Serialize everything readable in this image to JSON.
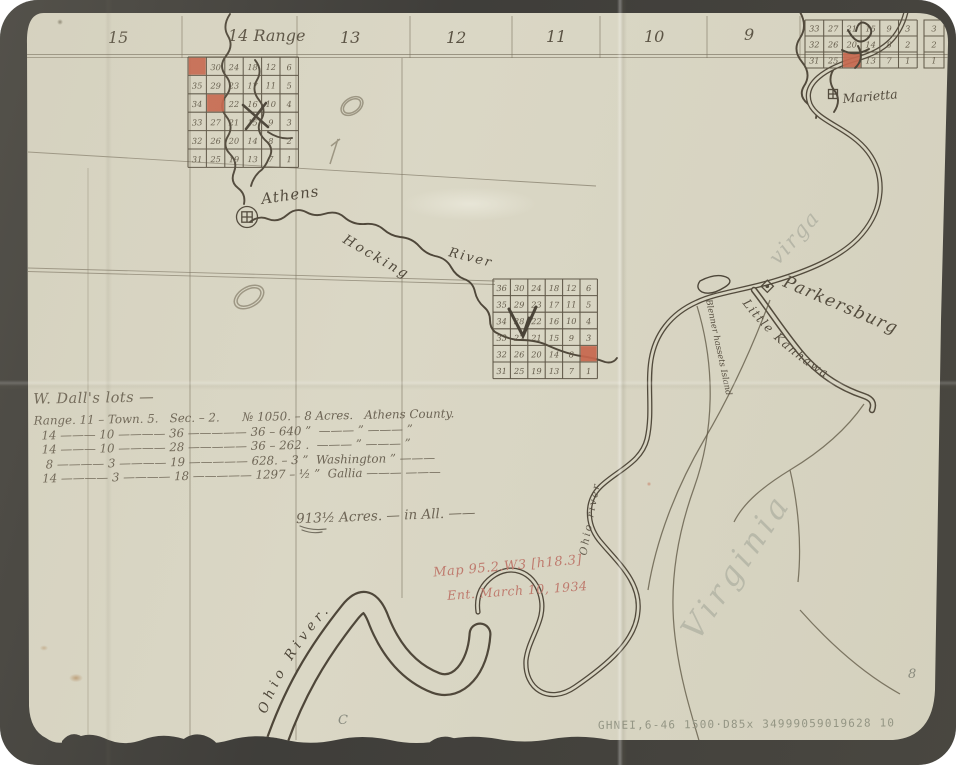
{
  "photo": {
    "background": "#111010",
    "paper_color": "#d8d5c3"
  },
  "colors": {
    "ink": "#241b0f",
    "faded_ink": "#43392a",
    "survey_line": "#5a523f",
    "section_red": "#c14227",
    "red_pencil": "#b65d52",
    "pencil": "#6f7268",
    "catalog_pencil": "#7d8171",
    "ghost": "#8f948a"
  },
  "map": {
    "range_labels": [
      {
        "text": "15"
      },
      {
        "text": "14 Range"
      },
      {
        "text": "13"
      },
      {
        "text": "12"
      },
      {
        "text": "11"
      },
      {
        "text": "10"
      },
      {
        "text": "9"
      }
    ],
    "places": {
      "athens": "Athens",
      "marietta": "Marietta",
      "parkersburg": "Parkersburg",
      "blennerhassett": "Blenner hassets Island"
    },
    "rivers": {
      "hocking_word1": "Hocking",
      "hocking_word2": "River",
      "ohio_channel": "Ohio River.",
      "ohio_small": "Ohio river",
      "little_kanhawa": "Little Kanhawa"
    },
    "ghost_text": {
      "top_right": "virga",
      "bottom_right": "Virginia"
    },
    "state_letters": "O I O"
  },
  "grids": [
    {
      "id": "township-grid-athens",
      "x": 188,
      "y": 57,
      "cell_w": 18.4,
      "cell_h": 18.4,
      "rows": 6,
      "columns": [
        [
          36,
          35,
          34,
          33,
          32,
          31
        ],
        [
          30,
          29,
          28,
          27,
          26,
          25
        ],
        [
          24,
          23,
          22,
          21,
          20,
          19
        ],
        [
          18,
          17,
          16,
          15,
          14,
          13
        ],
        [
          12,
          11,
          10,
          9,
          8,
          7
        ],
        [
          6,
          5,
          4,
          3,
          2,
          1
        ]
      ],
      "red_cells": [
        {
          "row": 0,
          "col": 0
        },
        {
          "row": 2,
          "col": 1
        }
      ]
    },
    {
      "id": "township-grid-hocking",
      "x": 493,
      "y": 279,
      "cell_w": 17.4,
      "cell_h": 16.6,
      "rows": 6,
      "columns": [
        [
          36,
          35,
          34,
          33,
          32,
          31
        ],
        [
          30,
          29,
          28,
          27,
          26,
          25
        ],
        [
          24,
          23,
          22,
          21,
          20,
          19
        ],
        [
          18,
          17,
          16,
          15,
          14,
          13
        ],
        [
          12,
          11,
          10,
          9,
          8,
          7
        ],
        [
          6,
          5,
          4,
          3,
          2,
          1
        ]
      ],
      "red_cells": [
        {
          "row": 4,
          "col": 5
        }
      ]
    },
    {
      "id": "township-grid-marietta",
      "x": 805,
      "y": 20,
      "cell_w": 18.7,
      "cell_h": 16,
      "rows": 3,
      "columns": [
        [
          33,
          32,
          31
        ],
        [
          27,
          26,
          25
        ],
        [
          21,
          20,
          19
        ],
        [
          15,
          14,
          13
        ],
        [
          9,
          8,
          7
        ],
        [
          3,
          2,
          1
        ]
      ],
      "red_cells": [
        {
          "row": 2,
          "col": 2
        }
      ],
      "extra_column": {
        "x": 924,
        "values": [
          3,
          2,
          1
        ]
      }
    }
  ],
  "notes": {
    "title": "W. Dall's lots —",
    "rows": [
      "Range. 11 – Town. 5.   Sec. – 2.      № 1050. – 8 Acres.   Athens County.",
      "  14 ——— 10 ———— 36 ————— 36 – 640 ”  ——— ” ——— ”",
      "  14 ——— 10 ———— 28 ————— 36 – 262 .  ——— ” ——— ”",
      "   8 ———— 3 ———— 19 ————— 628. – 3 ”  Washington ” ———",
      "  14 ———— 3 ———— 18 ————— 1297 – ½ ”  Gallia ——— ———"
    ],
    "total": "913½ Acres. — in All. ——"
  },
  "annotations": {
    "map_ref": "Map 95.2.W3 [h18.3]",
    "entry_date": "Ent. March 10, 1934",
    "catalog_line": "GHNEI,6-46 1500·D85x  34999059019628  10",
    "page_mark": "8",
    "c_mark": "C"
  }
}
